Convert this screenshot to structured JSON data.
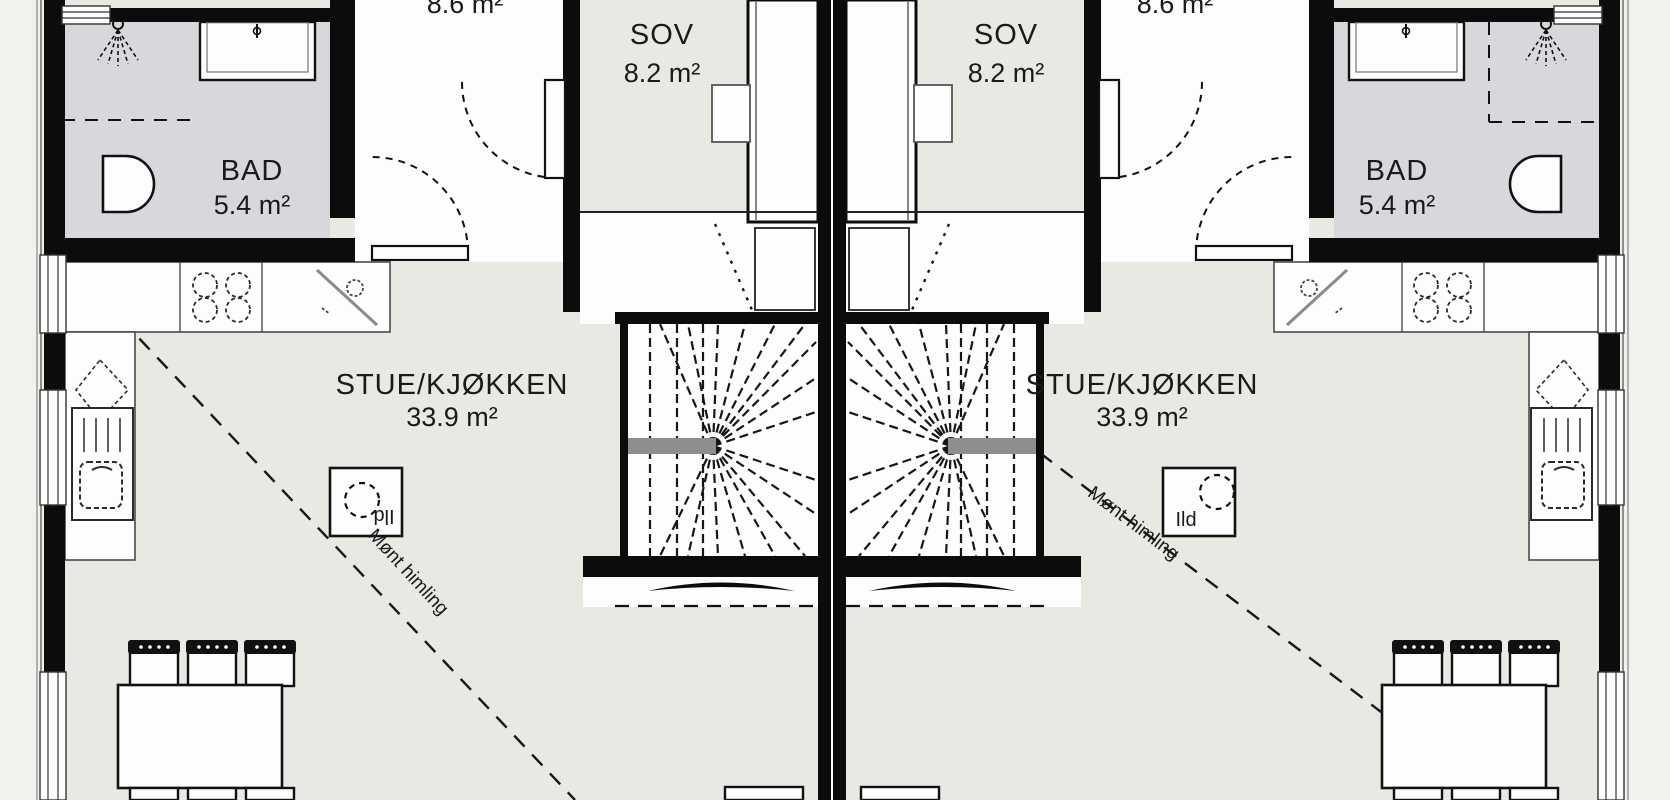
{
  "meta": {
    "type": "architectural floor plan",
    "description": "Mirrored duplex floor plan, two identical units",
    "language": "Norwegian"
  },
  "colors": {
    "wall": "#0c0c0c",
    "floor": "#e9e8e2",
    "bathroom_floor": "#d7d8db",
    "white_area": "#fdfdfd",
    "handrail_gray": "#8e8e8e",
    "outside": "#f2f1ed"
  },
  "icons": {
    "shower": "shower-head with spray lines",
    "toilet": "D-shaped bowl",
    "cooktop": "four dashed burner circles",
    "sink": "diagonal drain line with circle",
    "fireplace": "dashed circle in box",
    "stairs": "winder stair with radiating treads"
  },
  "labels": {
    "left_unit": {
      "bathroom_name": "BAD",
      "bathroom_area": "5.4 m²",
      "bedroom_name": "SOV",
      "bedroom_area": "8.2 m²",
      "living_name": "STUE/KJØKKEN",
      "living_area": "33.9 m²",
      "hall_area_partial": "8.6 m²",
      "fireplace": "Ild",
      "ceiling_note": "Mønt himling"
    },
    "right_unit": {
      "bathroom_name": "BAD",
      "bathroom_area": "5.4 m²",
      "bedroom_name": "SOV",
      "bedroom_area": "8.2 m²",
      "living_name": "STUE/KJØKKEN",
      "living_area": "33.9 m²",
      "hall_area_partial": "8.6 m²",
      "fireplace": "Ild",
      "ceiling_note": "Mønt himling"
    }
  }
}
